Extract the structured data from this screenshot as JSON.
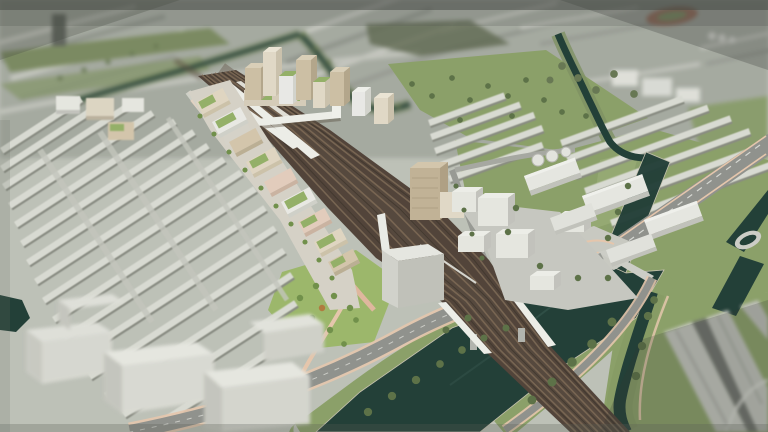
{
  "meta": {
    "title": "Aerial 3D masterplan visualization",
    "canvas_width": 768,
    "canvas_height": 432,
    "style": "tilt-shift aerial architectural render, desaturated palette, no on-screen text"
  },
  "palette": {
    "base_ground": "#bfc3ba",
    "background_city": "#a6aba2",
    "background_green": "#7a8a60",
    "haze": "#454a44",
    "terrace_roof": "#dcded6",
    "terrace_shadow": "#888b82",
    "massing_white": "#e9eae4",
    "massing_shade": "#c4c5bf",
    "field_green": "#8ba168",
    "park_green": "#9cb96a",
    "tree_green": "#5a7045",
    "street_tree_green": "#6f9048",
    "olive_tree": "#667752",
    "water": "#1d3b34",
    "rail_bed": "#4e4036",
    "rail_track": "#7a6753",
    "rail_dark": "#3a3028",
    "road": "#90928e",
    "road_light": "#cdcec7",
    "path_pink": "#e9c9ae",
    "dev_cream": "#e3d9c4",
    "dev_tan": "#d6c8ad",
    "dev_pink": "#e6cfbf",
    "green_roof": "#94b167",
    "bridge_white": "#f1f2ed",
    "autumn_tree": "#b27a3c",
    "stadium_track": "#9a6a56"
  },
  "scene": {
    "view": "high-angle aerial view over a railway corridor running diagonally through a city",
    "regions": {
      "background": "blurred low-rise city fabric with tree-lined canal, running-track oval and waterworks tanks",
      "railway": "wide multi-track brown corridor with white station canopies and a footbridge, narrowing to a rail bridge over the river",
      "station_quarter": "new mid-rise blocks with cream, tan and pink facades and bright green roofs along the west side of the tracks, high-rise cluster at the north end",
      "terraces": "dense rows of existing terraced housing filling the west half of the frame",
      "east_side": "white massing blocks, a tan tower, and industrial sheds with storage tanks on sage-green fields",
      "water": "dark teal canal and river basin crossed by rail and road bridges, tree-lined banks with pink paths",
      "foreground": "blurred white development blocks bottom-left and warehouse rooftops bottom-right, darkened vignette corners"
    }
  }
}
